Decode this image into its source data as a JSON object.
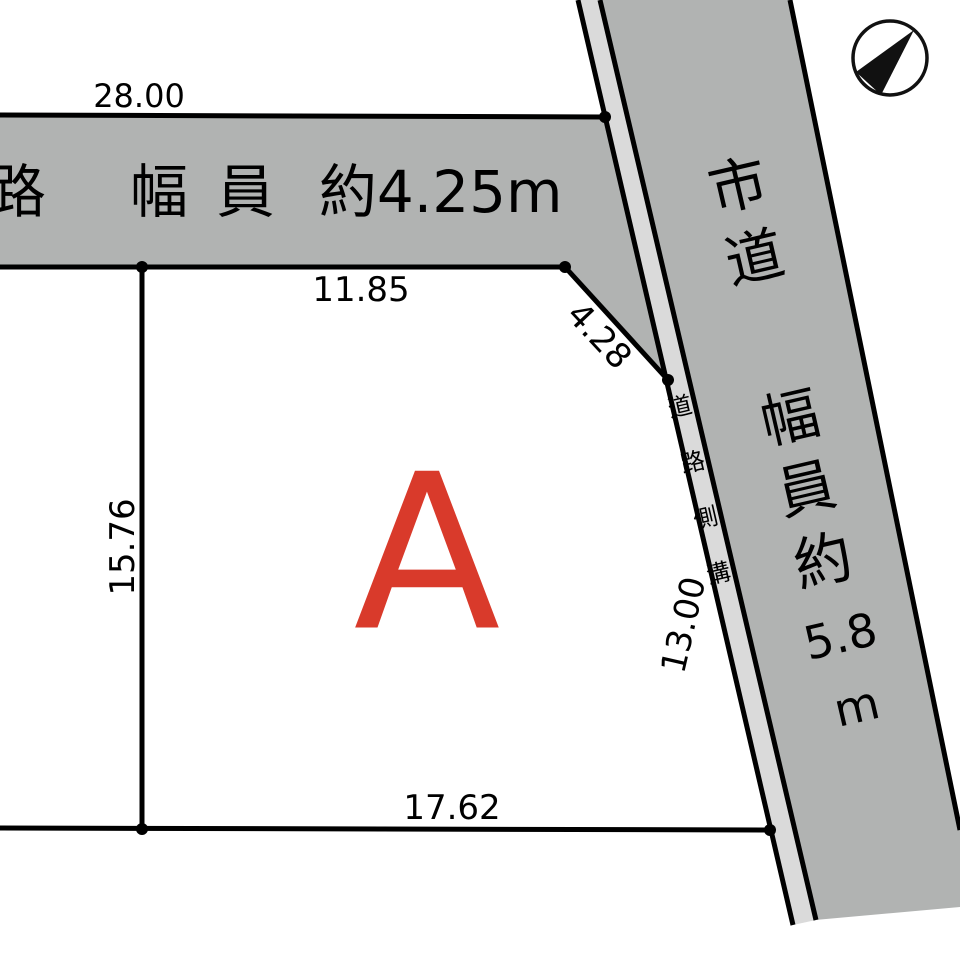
{
  "colors": {
    "background": "#ffffff",
    "road_fill": "#b1b3b2",
    "gutter_fill": "#dadada",
    "line": "#000000",
    "plot_label": "#d93a2b",
    "compass": "#111111"
  },
  "icons": {
    "north_arrow": "north-arrow"
  },
  "plot": {
    "label": "A"
  },
  "dimensions": {
    "top_road_frontage": "28.00",
    "north_boundary": "11.85",
    "corner_cut": "4.28",
    "west_boundary": "15.76",
    "east_boundary": "13.00",
    "south_boundary": "17.62"
  },
  "top_road": {
    "name": "道路",
    "width_parts": [
      "幅",
      "員",
      "約4.25m"
    ],
    "full_label": "道路 幅員約4.25m"
  },
  "side_road": {
    "name_chars": [
      "市",
      "道"
    ],
    "width_chars": [
      "幅",
      "員",
      "約",
      "5.8",
      "m"
    ],
    "full_label": "市道 幅員約5.8m"
  },
  "gutter": {
    "chars": [
      "道",
      "路",
      "側",
      "溝"
    ],
    "full_label": "道路側溝"
  }
}
